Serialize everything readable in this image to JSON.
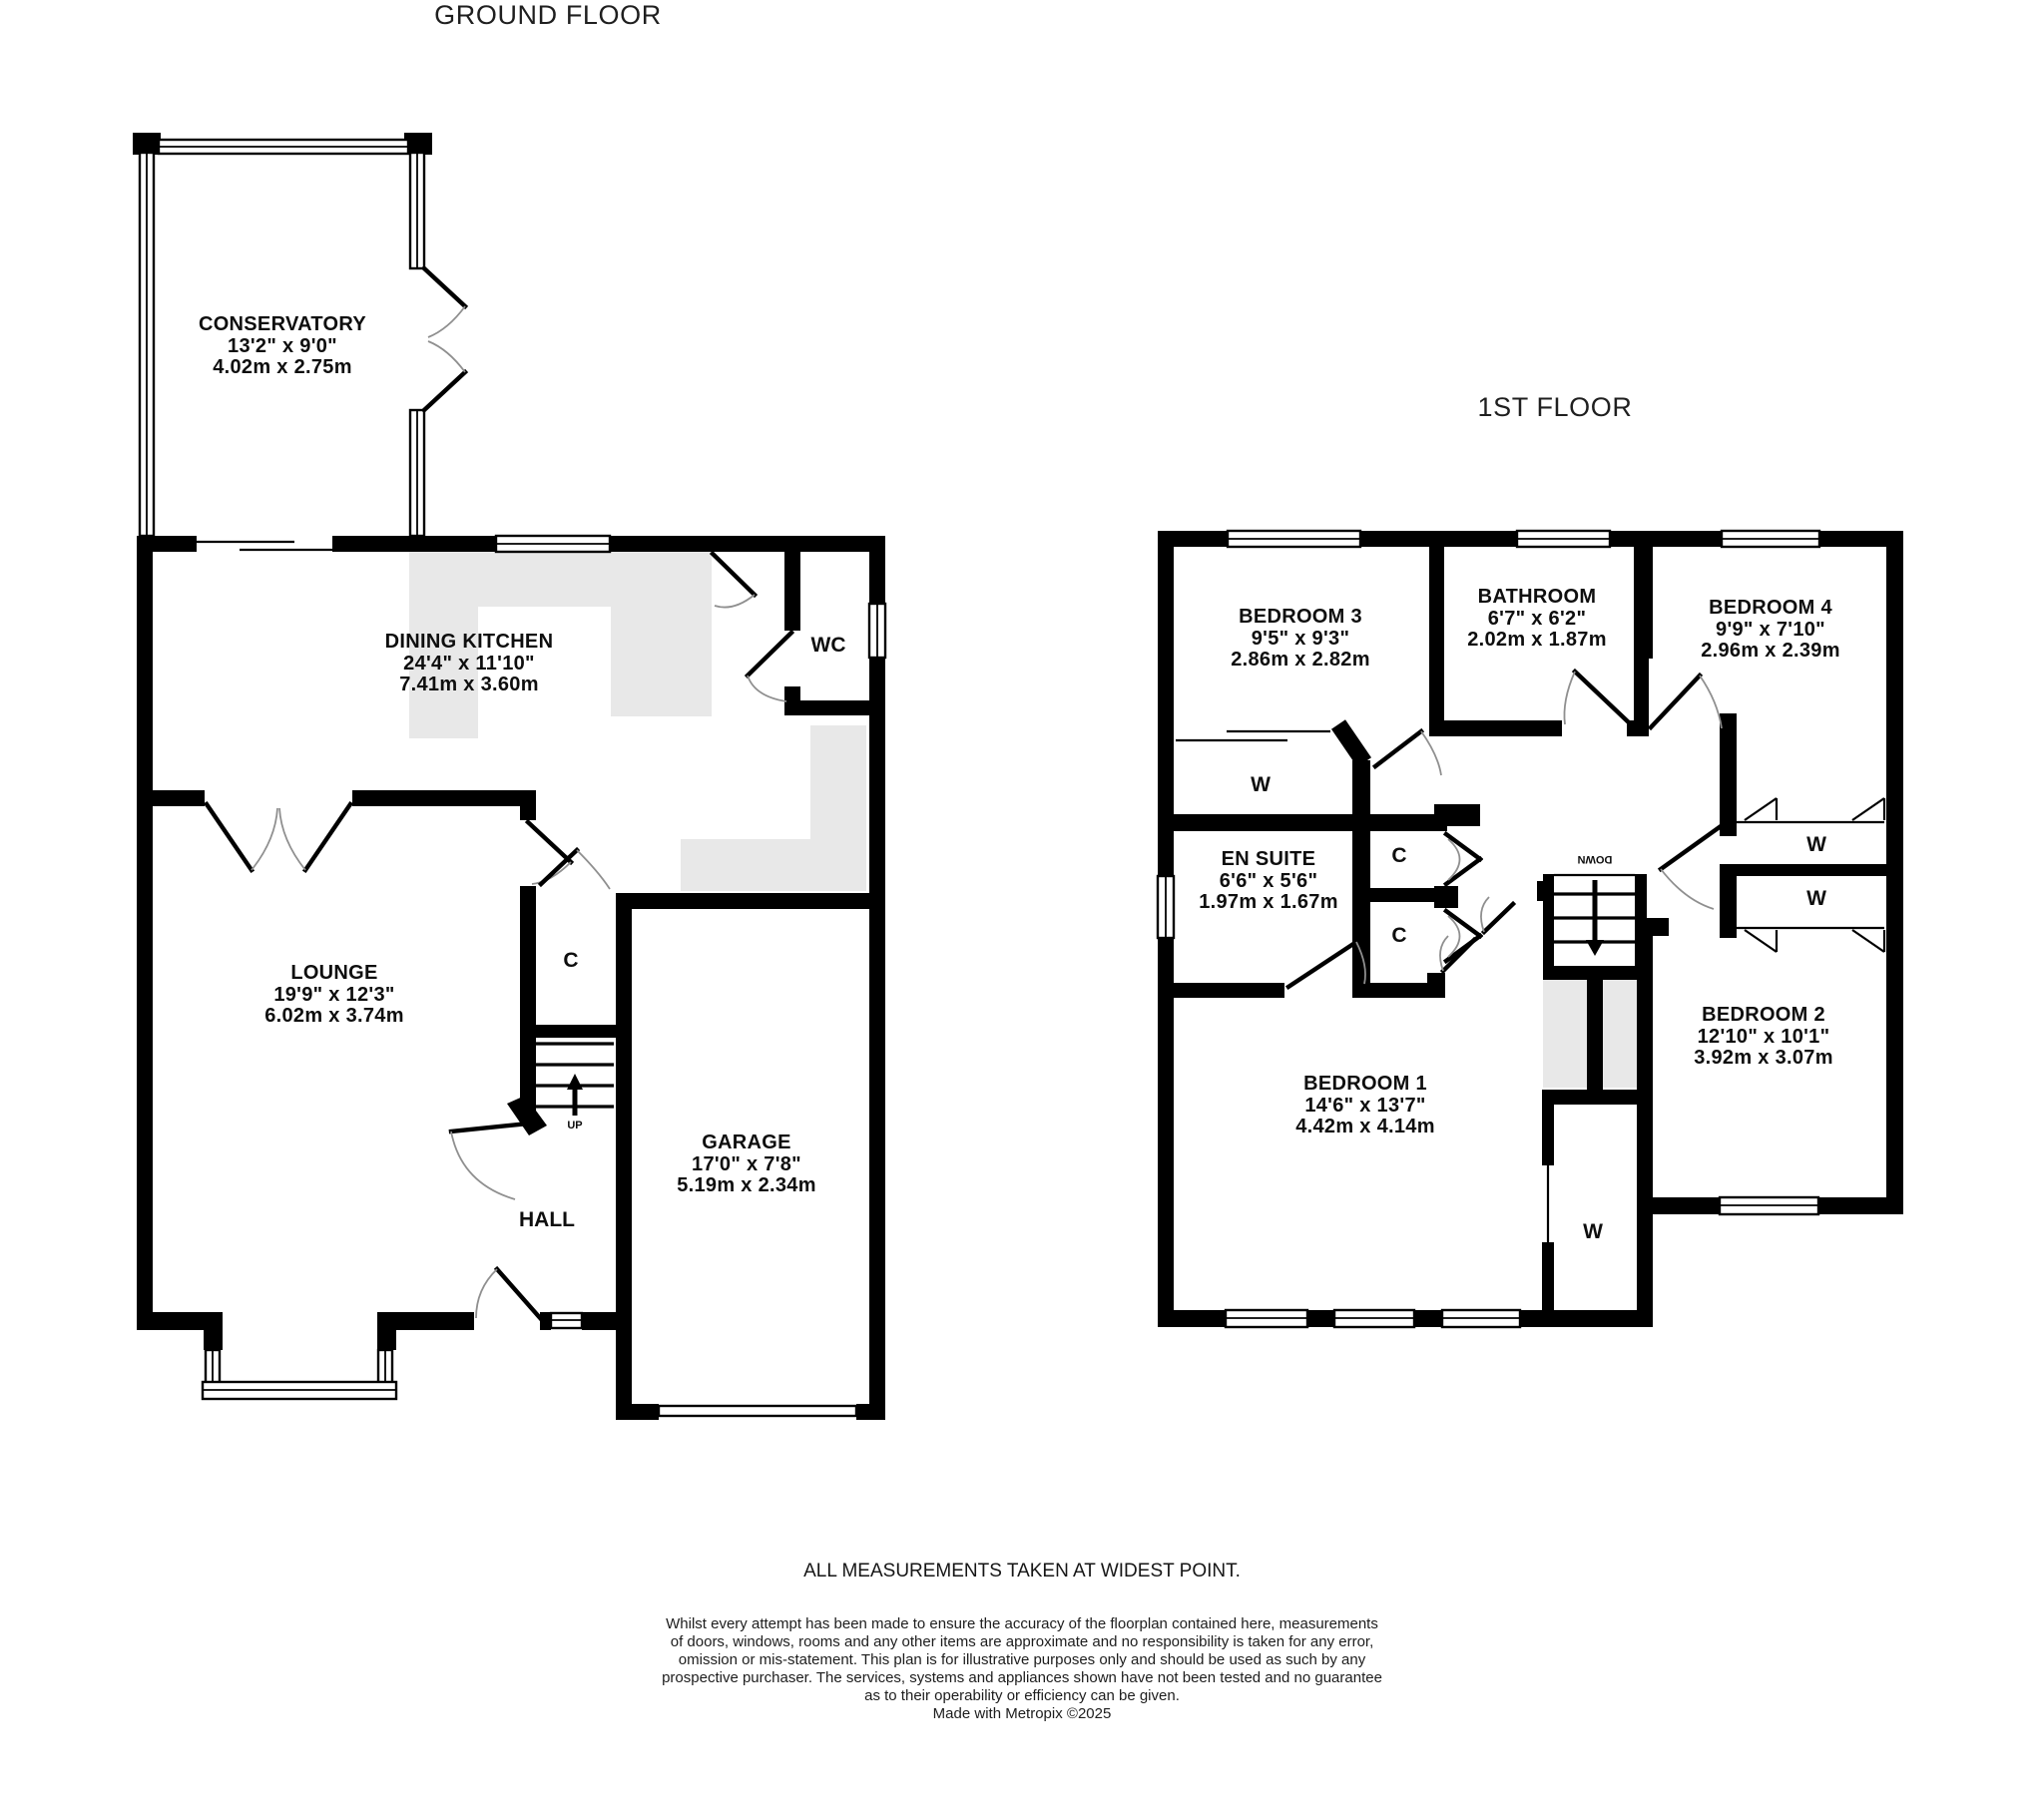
{
  "titles": {
    "ground_floor": "GROUND FLOOR",
    "first_floor": "1ST FLOOR"
  },
  "colors": {
    "wall": "#000000",
    "counter": "#e8e8e8",
    "background": "#ffffff",
    "door_arc": "#8f8f8f",
    "text": "#0e0e0e"
  },
  "ground_floor": {
    "rooms": {
      "conservatory": {
        "name": "CONSERVATORY",
        "imperial": "13'2\"  x 9'0\"",
        "metric": "4.02m  x 2.75m"
      },
      "dining_kitchen": {
        "name": "DINING KITCHEN",
        "imperial": "24'4\"  x 11'10\"",
        "metric": "7.41m  x 3.60m"
      },
      "lounge": {
        "name": "LOUNGE",
        "imperial": "19'9\"  x 12'3\"",
        "metric": "6.02m  x 3.74m"
      },
      "garage": {
        "name": "GARAGE",
        "imperial": "17'0\"  x 7'8\"",
        "metric": "5.19m  x 2.34m"
      }
    },
    "labels": {
      "wc": "WC",
      "hall": "HALL",
      "closet": "C",
      "stairs_up": "UP"
    }
  },
  "first_floor": {
    "rooms": {
      "bedroom_3": {
        "name": "BEDROOM 3",
        "imperial": "9'5\"  x 9'3\"",
        "metric": "2.86m  x 2.82m"
      },
      "bathroom": {
        "name": "BATHROOM",
        "imperial": "6'7\"  x 6'2\"",
        "metric": "2.02m  x 1.87m"
      },
      "bedroom_4": {
        "name": "BEDROOM 4",
        "imperial": "9'9\"  x 7'10\"",
        "metric": "2.96m  x 2.39m"
      },
      "en_suite": {
        "name": "EN SUITE",
        "imperial": "6'6\"  x 5'6\"",
        "metric": "1.97m  x 1.67m"
      },
      "bedroom_1": {
        "name": "BEDROOM 1",
        "imperial": "14'6\"  x 13'7\"",
        "metric": "4.42m  x 4.14m"
      },
      "bedroom_2": {
        "name": "BEDROOM 2",
        "imperial": "12'10\"  x 10'1\"",
        "metric": "3.92m  x 3.07m"
      }
    },
    "labels": {
      "wardrobe": "W",
      "closet": "C",
      "stairs_down": "DOWN"
    }
  },
  "footer": {
    "measurements_note": "ALL MEASUREMENTS TAKEN AT WIDEST POINT.",
    "disclaimer_lines": [
      "Whilst every attempt has been made to ensure the accuracy of the floorplan contained here, measurements",
      "of doors, windows, rooms and any other items are approximate and no responsibility is taken for any error,",
      "omission or mis-statement. This plan is for illustrative purposes only and should be used as such by any",
      "prospective purchaser. The services, systems and appliances shown have not been tested and no guarantee",
      "as to their operability or efficiency can be given."
    ],
    "credit": "Made with Metropix ©2025"
  }
}
